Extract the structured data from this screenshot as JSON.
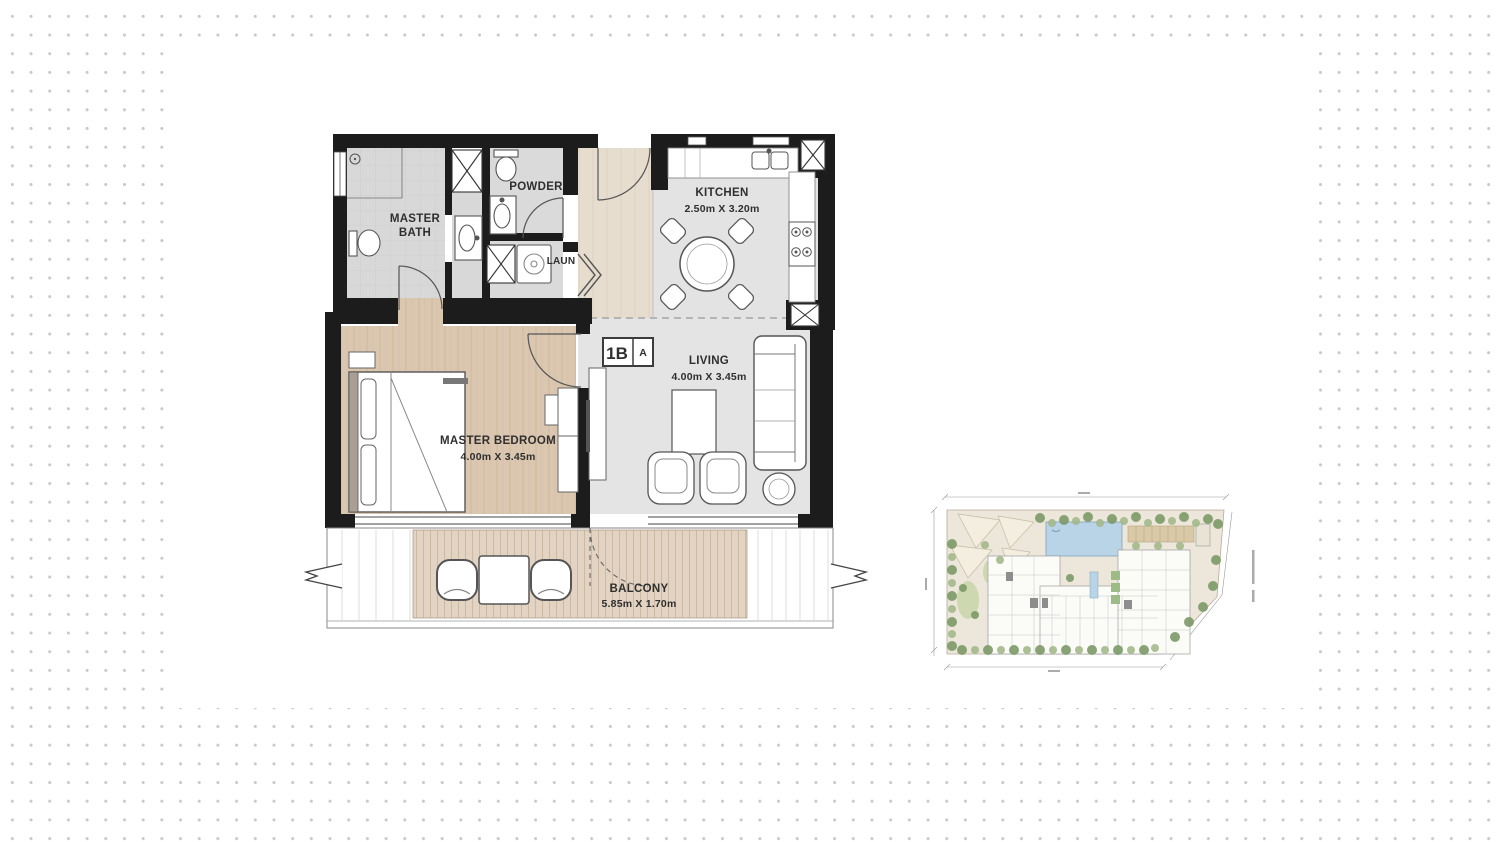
{
  "floor_plan": {
    "unit_badge": {
      "unit_code": "1B",
      "variant": "A"
    },
    "rooms": {
      "master_bath": {
        "label_line1": "MASTER",
        "label_line2": "BATH"
      },
      "powder": {
        "label": "POWDER"
      },
      "laundry": {
        "label": "LAUN"
      },
      "kitchen": {
        "label": "KITCHEN",
        "dimensions": "2.50m X 3.20m"
      },
      "living": {
        "label": "LIVING",
        "dimensions": "4.00m X 3.45m"
      },
      "master_bedroom": {
        "label": "MASTER BEDROOM",
        "dimensions": "4.00m X 3.45m"
      },
      "balcony": {
        "label": "BALCONY",
        "dimensions": "5.85m X 1.70m"
      }
    }
  },
  "site_plan": {
    "pool_color": "#b9d3e7",
    "landscape_color": "#ece7da",
    "tree_color_dark": "#7d9a68",
    "tree_color_light": "#a4b98b",
    "building_color": "#fbfbf8"
  },
  "style": {
    "wall_color": "#1c1c1c",
    "tile_floor_color": "#d8d8d8",
    "wood_floor_color": "#dbc7b0",
    "deck_floor_color": "#e2d3c2",
    "label_color": "#2f2f2f",
    "background_dot_color": "#c9c9c9"
  }
}
